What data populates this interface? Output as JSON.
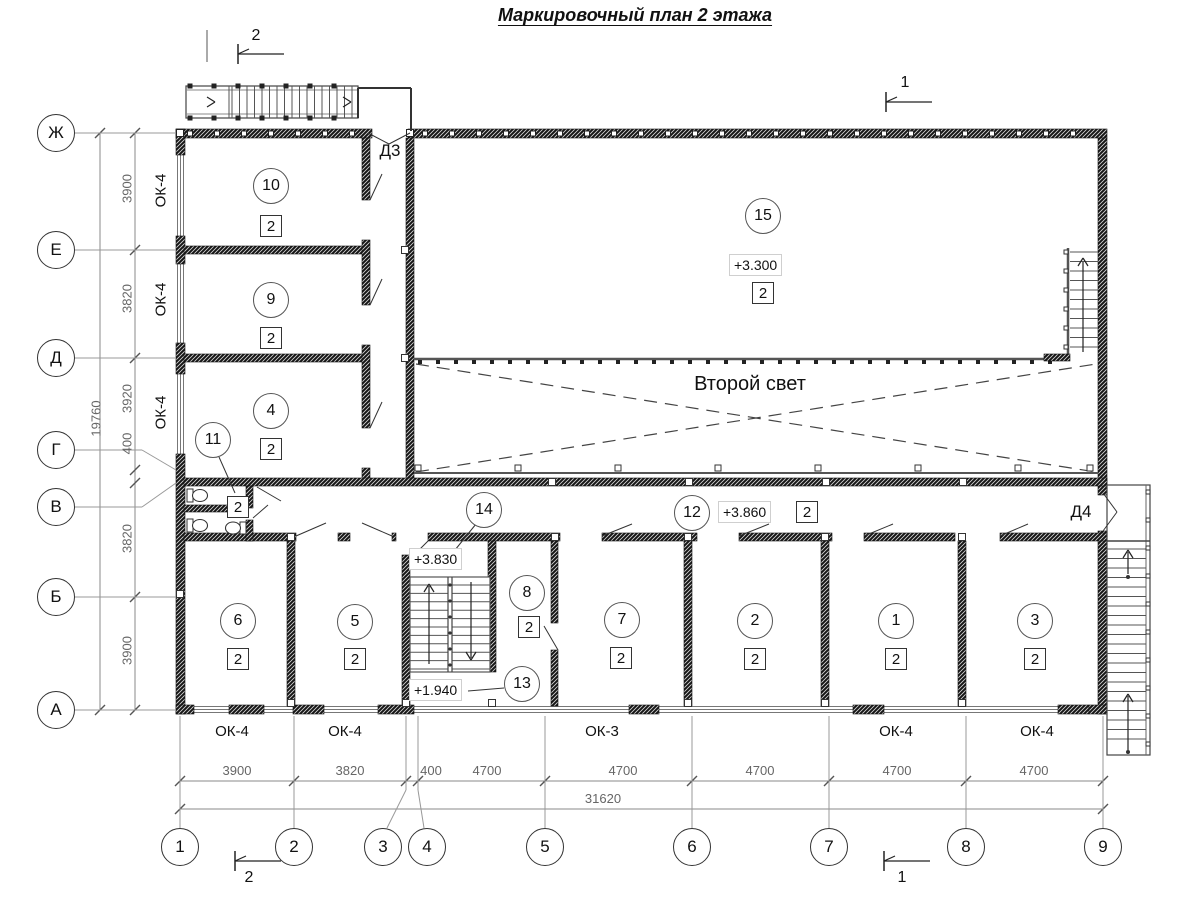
{
  "title": "Маркировочный план 2 этажа",
  "atrium_label": "Второй свет",
  "axes": {
    "vertical": [
      "Ж",
      "Е",
      "Д",
      "Г",
      "В",
      "Б",
      "А"
    ],
    "horizontal": [
      "1",
      "2",
      "3",
      "4",
      "5",
      "6",
      "7",
      "8",
      "9"
    ]
  },
  "dims": {
    "left": [
      "3900",
      "3820",
      "3920",
      "400",
      "3820",
      "3900"
    ],
    "left_total": "19760",
    "bottom": [
      "3900",
      "3820",
      "400",
      "4700",
      "4700",
      "4700",
      "4700",
      "4700"
    ],
    "bottom_total": "31620"
  },
  "windows": {
    "left": [
      "ОК-4",
      "ОК-4",
      "ОК-4"
    ],
    "bottom": [
      "ОК-4",
      "ОК-4",
      "ОК-3",
      "ОК-4",
      "ОК-4"
    ]
  },
  "doors": {
    "d3": "Д3",
    "d4": "Д4"
  },
  "sections": {
    "s1": "1",
    "s2": "2"
  },
  "rooms": [
    {
      "number": "10",
      "type": "2"
    },
    {
      "number": "9",
      "type": "2"
    },
    {
      "number": "4",
      "type": "2"
    },
    {
      "number": "11",
      "type": "2"
    },
    {
      "number": "15",
      "type": "2",
      "elevation": "+3.300"
    },
    {
      "number": "12",
      "type": "2",
      "elevation": "+3.860"
    },
    {
      "number": "14",
      "elevation": "+3.830"
    },
    {
      "number": "13",
      "elevation": "+1.940"
    },
    {
      "number": "8",
      "type": "2"
    },
    {
      "number": "6",
      "type": "2"
    },
    {
      "number": "5",
      "type": "2"
    },
    {
      "number": "7",
      "type": "2"
    },
    {
      "number": "2",
      "type": "2"
    },
    {
      "number": "1",
      "type": "2"
    },
    {
      "number": "3",
      "type": "2"
    }
  ]
}
